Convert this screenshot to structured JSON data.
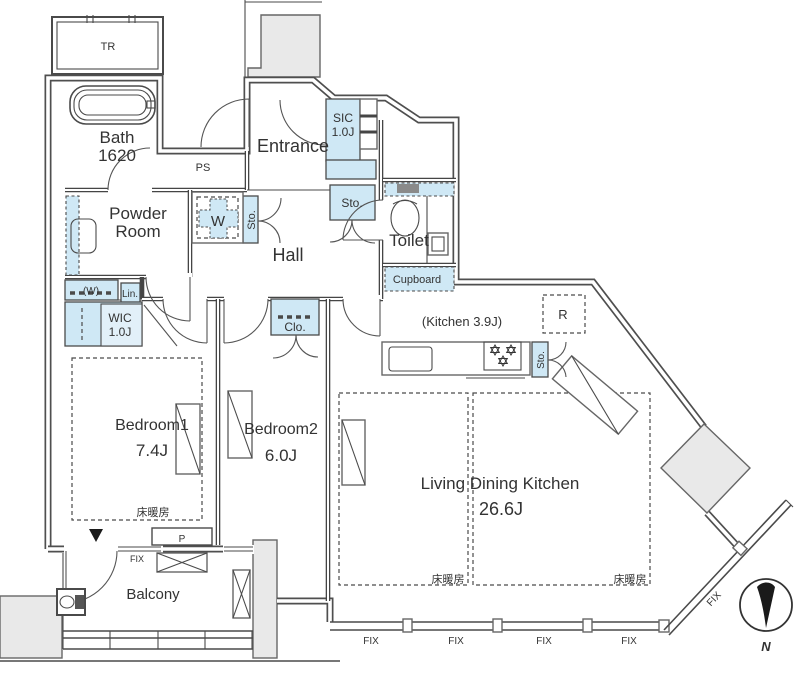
{
  "plan": {
    "rooms": {
      "tr": "TR",
      "bath": "Bath",
      "bath_size": "1620",
      "ps": "PS",
      "entrance": "Entrance",
      "sic": "SIC",
      "sic_size": "1.0J",
      "storage": "Sto.",
      "toilet": "Toilet",
      "cupboard": "Cupboard",
      "powder_line1": "Powder",
      "powder_line2": "Room",
      "washer": "W",
      "hall": "Hall",
      "washer_paren": "(W)",
      "linen": "Lin.",
      "wic": "WIC",
      "wic_size": "1.0J",
      "closet": "Clo.",
      "kitchen": "(Kitchen 3.9J)",
      "refrigerator": "R",
      "bedroom1": "Bedroom1",
      "bedroom1_size": "7.4J",
      "bedroom2": "Bedroom2",
      "bedroom2_size": "6.0J",
      "ldk": "Living Dining Kitchen",
      "ldk_size": "26.6J",
      "balcony": "Balcony"
    },
    "annotations": {
      "floor_heating": "床暖房",
      "fix_window": "FIX",
      "pipe": "P",
      "north": "N"
    }
  },
  "colors": {
    "storage_fill": "#cfe8f5",
    "exterior_fill": "#e9e9e9",
    "wall": "#4a4a4a"
  }
}
